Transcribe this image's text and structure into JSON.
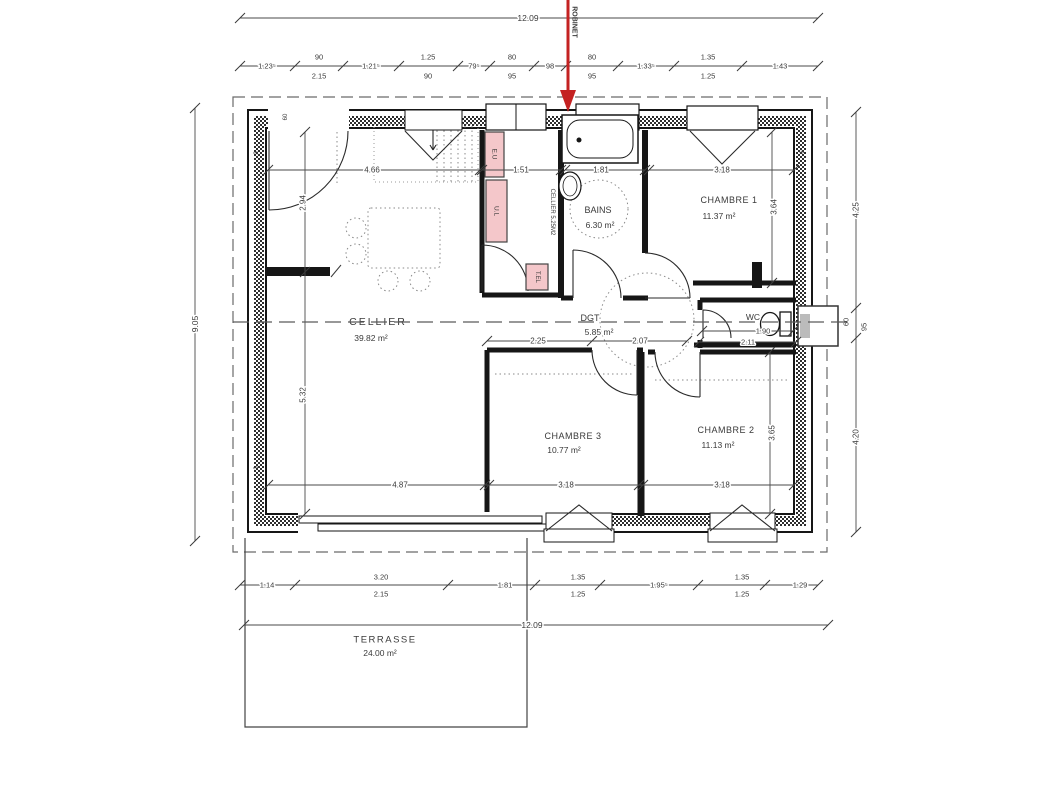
{
  "colors": {
    "text": "#3a3a3a",
    "wall": "#161616",
    "dim_line": "#4a4a4a",
    "pink": "#f4c7ca",
    "arrow_red": "#c42222",
    "annotation_blue": "#2b4b9e",
    "dash_gray": "#6a6a6a"
  },
  "plan": {
    "labels": {
      "overall_dimensions": [
        {
          "n": "dim-overall-width-top",
          "t": "12.09",
          "x": 528,
          "y": 18,
          "s": 8.5,
          "halo": true
        },
        {
          "n": "dim-overall-height-left",
          "t": "9.05",
          "x": 195,
          "y": 324,
          "r": -90,
          "s": 8.5,
          "halo": true
        },
        {
          "n": "dim-overall-width-bottom",
          "t": "12.09",
          "x": 532,
          "y": 625,
          "s": 8.5,
          "halo": true
        },
        {
          "n": "dim-right-4-25",
          "t": "4.25",
          "x": 856,
          "y": 210,
          "r": -90,
          "s": 8,
          "halo": true
        },
        {
          "n": "dim-right-60",
          "t": "60",
          "x": 846,
          "y": 322,
          "r": -90,
          "s": 7.5,
          "halo": true
        },
        {
          "n": "dim-right-95",
          "t": "95",
          "x": 864,
          "y": 327,
          "r": -90,
          "s": 7.5,
          "halo": true
        },
        {
          "n": "dim-right-4-20",
          "t": "4.20",
          "x": 856,
          "y": 437,
          "r": -90,
          "s": 8,
          "halo": true
        }
      ],
      "top_dimension_chain": [
        {
          "n": "dim-top-1-235",
          "t": "1.23⁵",
          "x": 267,
          "y": 66,
          "s": 7.5,
          "halo": true
        },
        {
          "n": "dim-top-90a",
          "t": "90",
          "x": 319,
          "y": 57,
          "s": 7.5
        },
        {
          "n": "dim-top-2-15",
          "t": "2.15",
          "x": 319,
          "y": 76,
          "s": 7.5
        },
        {
          "n": "dim-top-1-215",
          "t": "1.21⁵",
          "x": 371,
          "y": 66,
          "s": 7.5,
          "halo": true
        },
        {
          "n": "dim-top-1-25",
          "t": "1.25",
          "x": 428,
          "y": 57,
          "s": 7.5
        },
        {
          "n": "dim-top-90b",
          "t": "90",
          "x": 428,
          "y": 76,
          "s": 7.5
        },
        {
          "n": "dim-top-795",
          "t": "79⁵",
          "x": 474,
          "y": 66,
          "s": 7.5,
          "halo": true
        },
        {
          "n": "dim-top-80a",
          "t": "80",
          "x": 512,
          "y": 57,
          "s": 7.5
        },
        {
          "n": "dim-top-95a",
          "t": "95",
          "x": 512,
          "y": 76,
          "s": 7.5
        },
        {
          "n": "dim-top-98",
          "t": "98",
          "x": 550,
          "y": 66,
          "s": 7.5,
          "halo": true
        },
        {
          "n": "dim-top-80b",
          "t": "80",
          "x": 592,
          "y": 57,
          "s": 7.5
        },
        {
          "n": "dim-top-95b",
          "t": "95",
          "x": 592,
          "y": 76,
          "s": 7.5
        },
        {
          "n": "dim-top-1-335",
          "t": "1.33⁵",
          "x": 646,
          "y": 66,
          "s": 7.5,
          "halo": true
        },
        {
          "n": "dim-top-1-35",
          "t": "1.35",
          "x": 708,
          "y": 57,
          "s": 7.5
        },
        {
          "n": "dim-top-1-25b",
          "t": "1.25",
          "x": 708,
          "y": 76,
          "s": 7.5
        },
        {
          "n": "dim-top-1-43",
          "t": "1.43",
          "x": 780,
          "y": 66,
          "s": 7.5,
          "halo": true
        }
      ],
      "interior_dimensions": [
        {
          "n": "dim-int-4-66",
          "t": "4.66",
          "x": 372,
          "y": 170,
          "s": 8,
          "halo": true
        },
        {
          "n": "dim-int-1-51",
          "t": "1.51",
          "x": 521,
          "y": 170,
          "s": 8,
          "halo": true
        },
        {
          "n": "dim-int-1-81",
          "t": "1.81",
          "x": 601,
          "y": 170,
          "s": 8,
          "halo": true
        },
        {
          "n": "dim-int-3-18a",
          "t": "3.18",
          "x": 722,
          "y": 170,
          "s": 8,
          "halo": true
        },
        {
          "n": "dim-int-2-94",
          "t": "2.94",
          "x": 303,
          "y": 203,
          "r": -90,
          "s": 8,
          "halo": true
        },
        {
          "n": "dim-int-5-32",
          "t": "5.32",
          "x": 303,
          "y": 395,
          "r": -90,
          "s": 8,
          "halo": true
        },
        {
          "n": "dim-int-3-64",
          "t": "3.64",
          "x": 774,
          "y": 207,
          "r": -90,
          "s": 8,
          "halo": true
        },
        {
          "n": "dim-int-3-65",
          "t": "3.65",
          "x": 772,
          "y": 433,
          "r": -90,
          "s": 8,
          "halo": true
        },
        {
          "n": "dim-int-2-25",
          "t": "2.25",
          "x": 538,
          "y": 341,
          "s": 8,
          "halo": true
        },
        {
          "n": "dim-int-2-07",
          "t": "2.07",
          "x": 640,
          "y": 341,
          "s": 8,
          "halo": true
        },
        {
          "n": "dim-int-1-90",
          "t": "1.90",
          "x": 763,
          "y": 331,
          "s": 7.5,
          "halo": true
        },
        {
          "n": "dim-int-2-11",
          "t": "2.11",
          "x": 748,
          "y": 342,
          "s": 7.5,
          "halo": true
        },
        {
          "n": "dim-int-4-87",
          "t": "4.87",
          "x": 400,
          "y": 485,
          "s": 8,
          "halo": true
        },
        {
          "n": "dim-int-3-18b",
          "t": "3.18",
          "x": 566,
          "y": 485,
          "s": 8,
          "halo": true
        },
        {
          "n": "dim-int-3-18c",
          "t": "3.18",
          "x": 722,
          "y": 485,
          "s": 8,
          "halo": true
        }
      ],
      "bottom_dimension_chain": [
        {
          "n": "dim-bot-1-14",
          "t": "1.14",
          "x": 267,
          "y": 585,
          "s": 7.5,
          "halo": true
        },
        {
          "n": "dim-bot-3-20",
          "t": "3.20",
          "x": 381,
          "y": 577,
          "s": 7.5
        },
        {
          "n": "dim-bot-2-15",
          "t": "2.15",
          "x": 381,
          "y": 594,
          "s": 7.5
        },
        {
          "n": "dim-bot-1-81",
          "t": "1.81",
          "x": 505,
          "y": 585,
          "s": 7.5,
          "halo": true
        },
        {
          "n": "dim-bot-1-35a",
          "t": "1.35",
          "x": 578,
          "y": 577,
          "s": 7.5
        },
        {
          "n": "dim-bot-1-25a",
          "t": "1.25",
          "x": 578,
          "y": 594,
          "s": 7.5
        },
        {
          "n": "dim-bot-1-955",
          "t": "1.95⁵",
          "x": 659,
          "y": 585,
          "s": 7.5,
          "halo": true
        },
        {
          "n": "dim-bot-1-35b",
          "t": "1.35",
          "x": 742,
          "y": 577,
          "s": 7.5
        },
        {
          "n": "dim-bot-1-25b",
          "t": "1.25",
          "x": 742,
          "y": 594,
          "s": 7.5
        },
        {
          "n": "dim-bot-1-29",
          "t": "1.29",
          "x": 800,
          "y": 585,
          "s": 7.5,
          "halo": true
        }
      ],
      "room_labels": [
        {
          "n": "room-cellier",
          "t": "CELLIER",
          "x": 378,
          "y": 322,
          "s": 10.5,
          "ls": 2
        },
        {
          "n": "area-cellier",
          "t": "39.82 m²",
          "x": 371,
          "y": 338,
          "s": 8.5
        },
        {
          "n": "room-dgt",
          "t": "DGT",
          "x": 590,
          "y": 318,
          "s": 9,
          "halo": true
        },
        {
          "n": "area-dgt",
          "t": "5.85 m²",
          "x": 599,
          "y": 332,
          "s": 8.5,
          "halo": true
        },
        {
          "n": "room-bains",
          "t": "BAINS",
          "x": 598,
          "y": 210,
          "s": 9,
          "halo": true
        },
        {
          "n": "area-bains",
          "t": "6.30 m²",
          "x": 600,
          "y": 225,
          "s": 8.5,
          "halo": true
        },
        {
          "n": "room-chambre-1",
          "t": "CHAMBRE 1",
          "x": 729,
          "y": 200,
          "s": 9,
          "ls": 0.5
        },
        {
          "n": "area-chambre-1",
          "t": "11.37 m²",
          "x": 719,
          "y": 216,
          "s": 8.5
        },
        {
          "n": "room-chambre-3",
          "t": "CHAMBRE 3",
          "x": 573,
          "y": 436,
          "s": 9,
          "ls": 0.5
        },
        {
          "n": "area-chambre-3",
          "t": "10.77 m²",
          "x": 564,
          "y": 450,
          "s": 8.5
        },
        {
          "n": "room-chambre-2",
          "t": "CHAMBRE 2",
          "x": 726,
          "y": 430,
          "s": 9,
          "ls": 0.5
        },
        {
          "n": "area-chambre-2",
          "t": "11.13 m²",
          "x": 718,
          "y": 445,
          "s": 8.5
        },
        {
          "n": "room-wc",
          "t": "WC",
          "x": 753,
          "y": 317,
          "s": 8.5,
          "halo": true
        },
        {
          "n": "room-terrasse",
          "t": "TERRASSE",
          "x": 385,
          "y": 640,
          "s": 9.5,
          "ls": 1.5
        },
        {
          "n": "area-terrasse",
          "t": "24.00 m²",
          "x": 380,
          "y": 653,
          "s": 8.5
        },
        {
          "n": "room-cellier-closet",
          "t": "CELLIER 5.25M2",
          "x": 552,
          "y": 212,
          "r": 90,
          "s": 6
        }
      ],
      "equipment_labels": [
        {
          "n": "equip-eu",
          "t": "E.U",
          "x": 494,
          "y": 154,
          "r": 90,
          "s": 6.5
        },
        {
          "n": "equip-ul",
          "t": "U.L",
          "x": 496,
          "y": 211,
          "r": 90,
          "s": 6.5
        },
        {
          "n": "equip-tel",
          "t": "T.EL",
          "x": 537,
          "y": 277,
          "r": 90,
          "s": 6
        }
      ],
      "wall_markers": [
        {
          "n": "marker-60-top-left",
          "t": "60",
          "x": 286,
          "y": 117,
          "r": -90,
          "s": 6
        },
        {
          "n": "marker-3-left-top",
          "t": "3",
          "x": 257,
          "y": 153,
          "r": -90,
          "s": 6
        },
        {
          "n": "marker-6-right-top",
          "t": "6",
          "x": 803,
          "y": 152,
          "r": -90,
          "s": 6
        },
        {
          "n": "marker-3-left-bottom",
          "t": "3",
          "x": 257,
          "y": 468,
          "r": -90,
          "s": 6
        },
        {
          "n": "marker-6-right-bottom",
          "t": "6",
          "x": 803,
          "y": 468,
          "r": -90,
          "s": 6
        }
      ],
      "annotation": [
        {
          "n": "robinet-label",
          "t": "ROBINET",
          "x": 574,
          "y": 22,
          "r": 90,
          "s": 7,
          "w": "bold",
          "c": "#2b4b9e"
        }
      ]
    }
  }
}
